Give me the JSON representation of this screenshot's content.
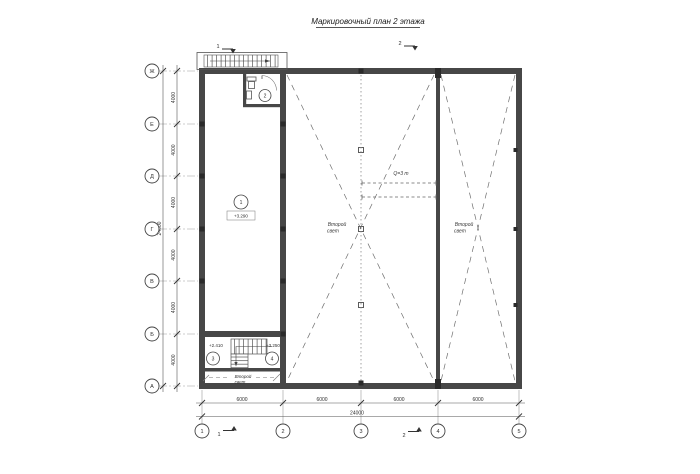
{
  "title": "Маркировочный план 2 этажа",
  "axes": {
    "horizontal": [
      "1",
      "2",
      "3",
      "4",
      "5"
    ],
    "vertical": [
      "Ж",
      "Е",
      "Д",
      "Г",
      "В",
      "Б",
      "А"
    ]
  },
  "dimensions": {
    "bottom_segments": [
      "6000",
      "6000",
      "6000",
      "6000"
    ],
    "bottom_total": "24000",
    "left_segments": [
      "4000",
      "4000",
      "4000",
      "4000",
      "4000",
      "4000"
    ],
    "left_total": "24000"
  },
  "rooms": [
    {
      "number": "1",
      "level": "+3.290"
    },
    {
      "number": "2"
    },
    {
      "number": "3",
      "level": "+2.410"
    },
    {
      "number": "4",
      "level": "+3.250"
    }
  ],
  "annotations": {
    "second_light_line1": "Второй",
    "second_light_line2": "свет",
    "crane": "Q=3 т"
  },
  "section_marks": {
    "mark1": "1",
    "mark2": "2"
  },
  "colors": {
    "ink": "#2f2f2f",
    "wall": "#474747",
    "dash": "#6f6f6f",
    "grid": "#8a8a8a"
  }
}
